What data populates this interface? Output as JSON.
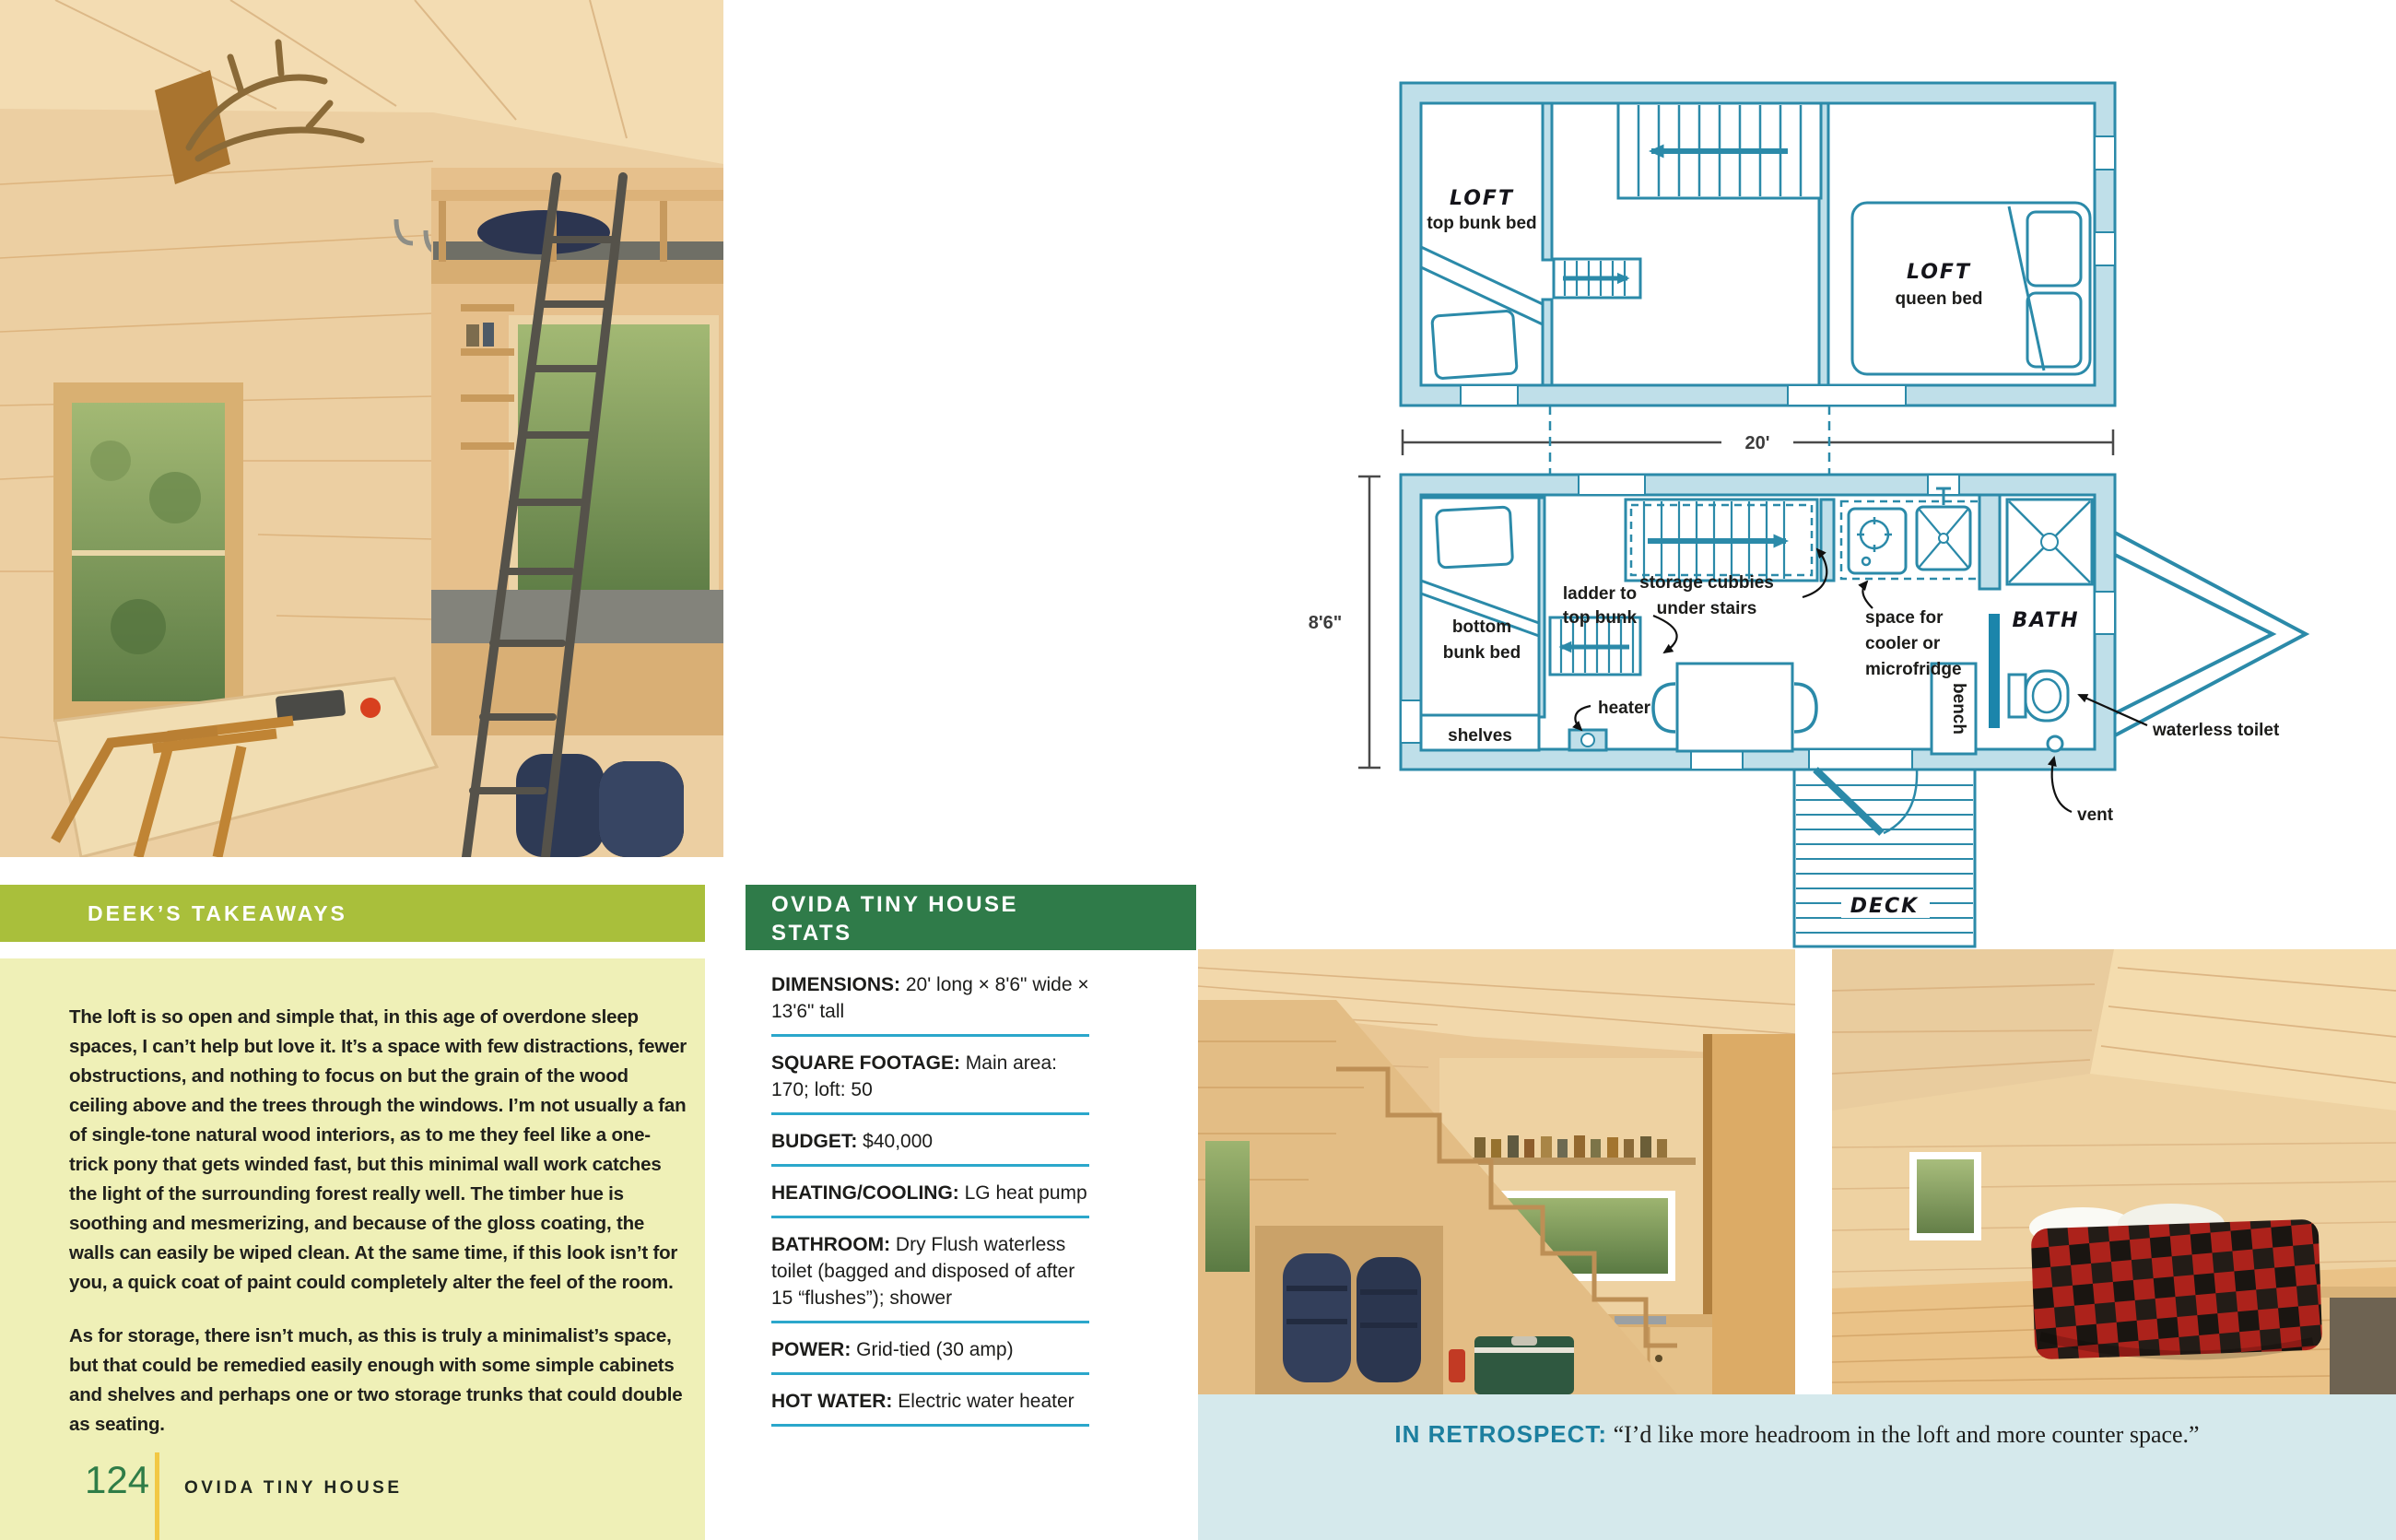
{
  "colors": {
    "lime_bar": "#a9bf3b",
    "pale_yellow_panel": "#eff0b7",
    "dark_green_header": "#2f7b49",
    "cyan_rule": "#2ba7cb",
    "plan_blue": "#2b8aa9",
    "plan_wall_fill": "#bfdfe9",
    "retrospect_band": "#d5e9ec",
    "retrospect_teal": "#1c7f9f",
    "page_number_green": "#2f7d47",
    "yellow_rule": "#f2c844"
  },
  "left_page": {
    "takeaways": {
      "heading": "DEEK’S TAKEAWAYS",
      "paragraph1": "The loft is so open and simple that, in this age of overdone sleep spaces, I can’t help but love it. It’s a space with few distractions, fewer obstructions, and nothing to focus on but the grain of the wood ceiling above and the trees through the windows. I’m not usually a fan of single-tone natural wood interiors, as to me they feel like a one-trick pony that gets winded fast, but this minimal wall work catches the light of the surrounding forest really well. The timber hue is soothing and mesmerizing, and because of the gloss coating, the walls can easily be wiped clean. At the same time, if this look isn’t for you, a quick coat of paint could completely alter the feel of the room.",
      "paragraph2": "As for storage, there isn’t much, as this is truly a minimalist’s space, but that could be remedied easily enough with some simple cabinets and shelves and perhaps one or two storage trunks that could double as seating."
    },
    "footer": {
      "page_number": "124",
      "title": "OVIDA TINY HOUSE"
    }
  },
  "stats_panel": {
    "heading_line1": "OVIDA TINY HOUSE",
    "heading_line2": "STATS",
    "items": [
      {
        "label": "DIMENSIONS:",
        "value": "20' long × 8'6\" wide × 13'6\" tall"
      },
      {
        "label": "SQUARE FOOTAGE:",
        "value": "Main area: 170; loft: 50"
      },
      {
        "label": "BUDGET:",
        "value": "$40,000"
      },
      {
        "label": "HEATING/COOLING:",
        "value": "LG heat pump"
      },
      {
        "label": "BATHROOM:",
        "value": "Dry Flush waterless toilet (bagged and disposed of after 15 “flushes”); shower"
      },
      {
        "label": "POWER:",
        "value": "Grid-tied (30 amp)"
      },
      {
        "label": "HOT WATER:",
        "value": "Electric water heater"
      }
    ]
  },
  "floor_plan": {
    "dim_length": "20'",
    "dim_width": "8'6\"",
    "loft_bunk_title": "LOFT",
    "loft_bunk_sub": "top bunk bed",
    "loft_queen_title": "LOFT",
    "loft_queen_sub": "queen bed",
    "storage_line1": "storage cubbies",
    "storage_line2": "under stairs",
    "ladder_line1": "ladder to",
    "ladder_line2": "top bunk",
    "cooler_line1": "space for",
    "cooler_line2": "cooler or",
    "cooler_line3": "microfridge",
    "bunk_line1": "bottom",
    "bunk_line2": "bunk bed",
    "shelves": "shelves",
    "heater": "heater",
    "bench": "bench",
    "bath": "BATH",
    "waterless_toilet": "waterless toilet",
    "vent": "vent",
    "deck": "DECK"
  },
  "retrospect": {
    "label": "IN RETROSPECT:",
    "quote": " “I’d like more headroom in the loft and more counter space.”"
  }
}
